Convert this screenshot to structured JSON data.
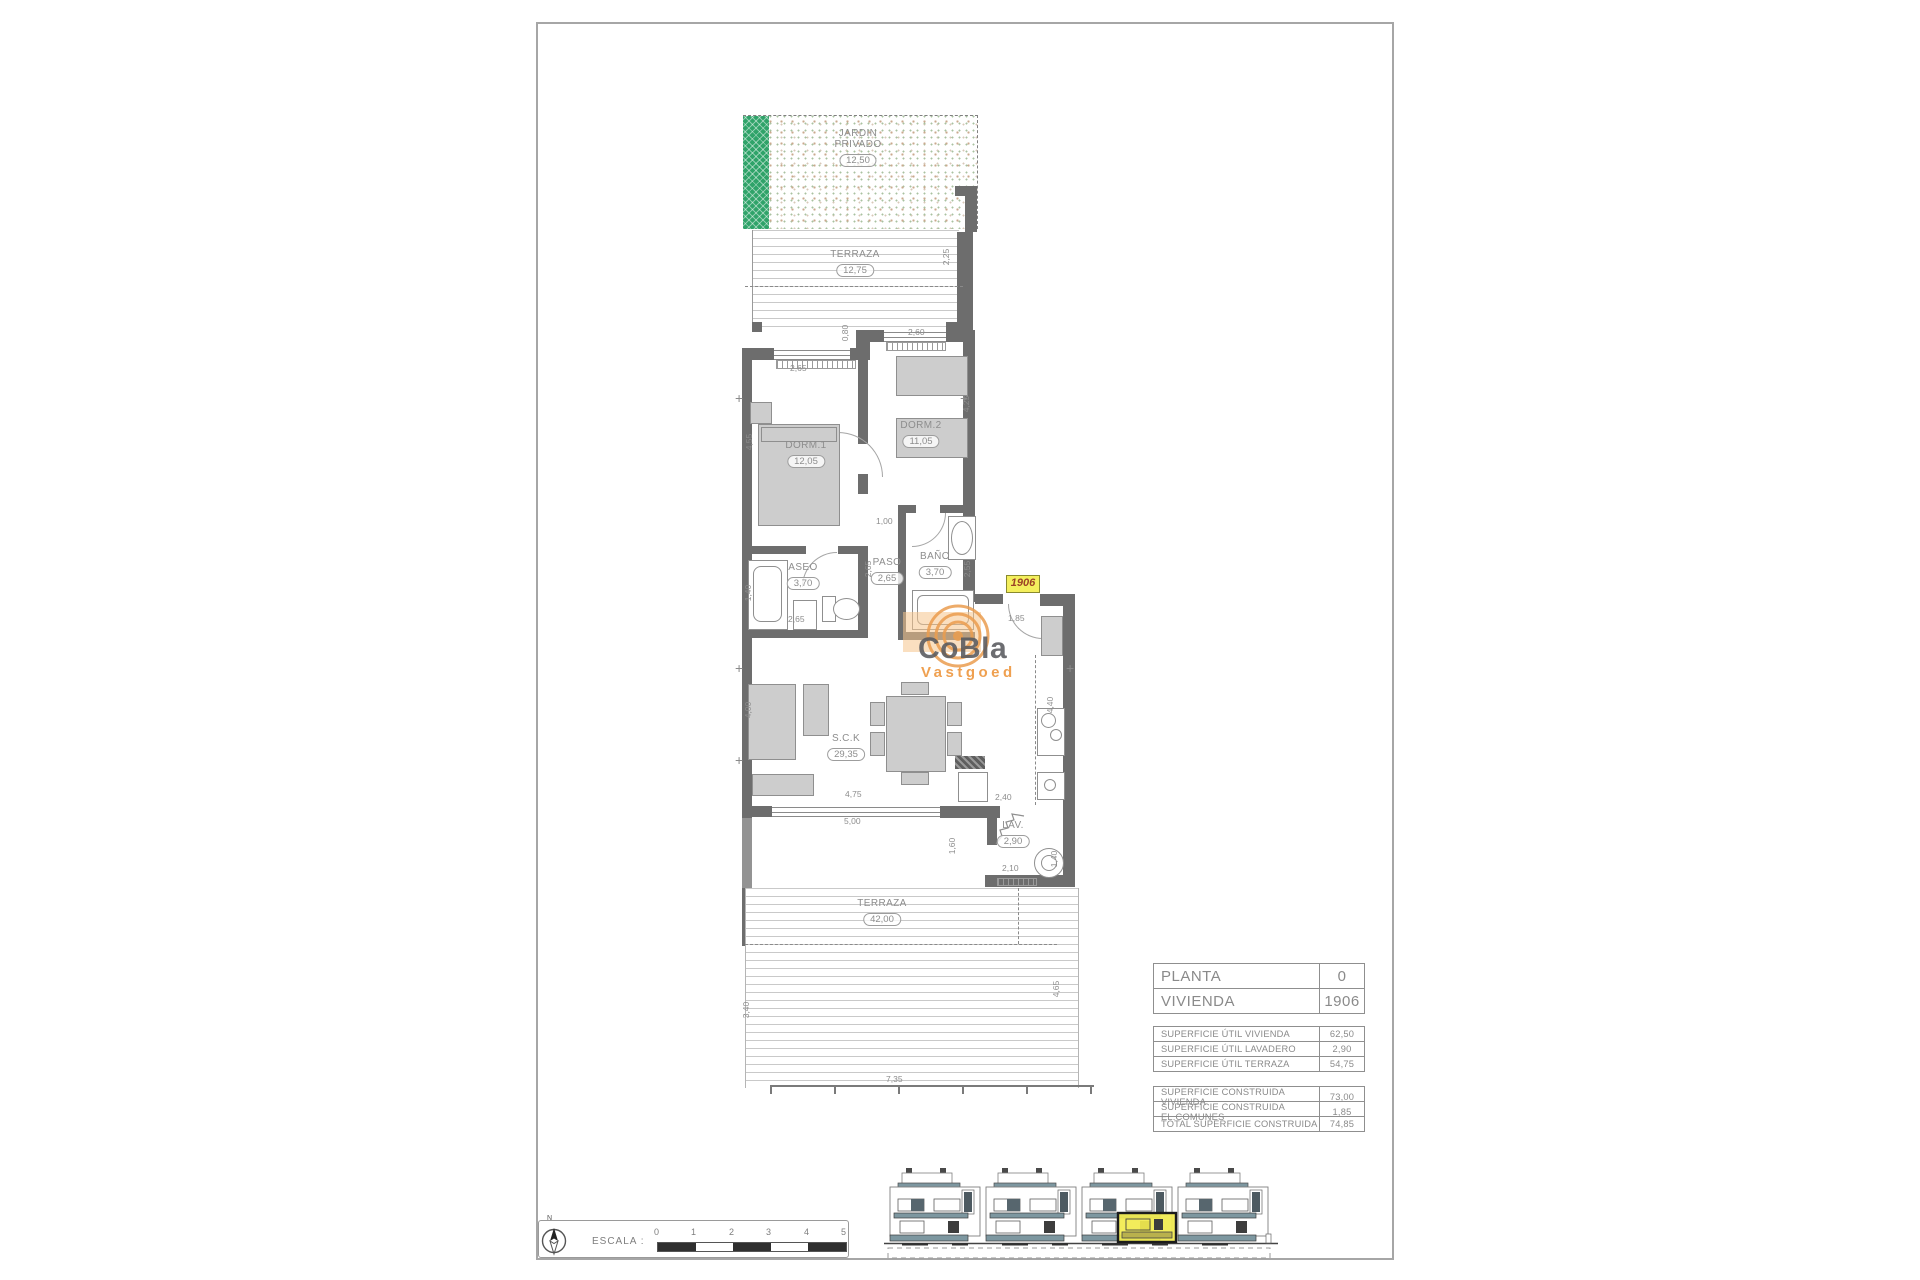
{
  "document": {
    "type_label": "floor plan drawing"
  },
  "unit_label": "1906",
  "logo": {
    "line1": "CoBla",
    "line2": "Vastgoed"
  },
  "rooms": [
    {
      "name": "JARDIN\nPRIVADO",
      "area": "12,50"
    },
    {
      "name": "TERRAZA",
      "area": "12,75"
    },
    {
      "name": "DORM.1",
      "area": "12,05"
    },
    {
      "name": "DORM.2",
      "area": "11,05"
    },
    {
      "name": "ASEO",
      "area": "3,70"
    },
    {
      "name": "PASO",
      "area": "2,65"
    },
    {
      "name": "BAÑO",
      "area": "3,70"
    },
    {
      "name": "S.C.K",
      "area": "29,35"
    },
    {
      "name": "LAV.",
      "area": "2,90"
    },
    {
      "name": "TERRAZA",
      "area": "42,00"
    }
  ],
  "dims": [
    "2,25",
    "0,80",
    "2,60",
    "2,65",
    "4,55",
    "4,25",
    "1,00",
    "2,65",
    "1,40",
    "2,65",
    "2,55",
    "1,85",
    "4,40",
    "4,00",
    "4,75",
    "5,00",
    "2,40",
    "2,10",
    "1,40",
    "1,60",
    "3,40",
    "4,65",
    "7,35"
  ],
  "table": {
    "unit_rows": [
      {
        "label": "PLANTA",
        "value": "0"
      },
      {
        "label": "VIVIENDA",
        "value": "1906"
      }
    ],
    "util_rows": [
      {
        "label": "SUPERFICIE ÚTIL VIVIENDA",
        "value": "62,50"
      },
      {
        "label": "SUPERFICIE ÚTIL LAVADERO",
        "value": "2,90"
      },
      {
        "label": "SUPERFICIE ÚTIL TERRAZA",
        "value": "54,75"
      }
    ],
    "built_rows": [
      {
        "label": "SUPERFICIE CONSTRUIDA VIVIENDA",
        "value": "73,00"
      },
      {
        "label": "SUPERFICIE CONSTRUIDA EL.COMUNES",
        "value": "1,85"
      },
      {
        "label": "TOTAL SUPERFICIE CONSTRUIDA",
        "value": "74,85"
      }
    ]
  },
  "scale": {
    "label": "ESCALA :",
    "ticks": [
      "0",
      "1",
      "2",
      "3",
      "4",
      "5"
    ],
    "north": "N"
  },
  "colors": {
    "wall": "#6d6d6d",
    "garden_green": "#2fa369",
    "highlight_yellow": "#f4ef5d",
    "logo_orange": "#efa050",
    "logo_gray": "#5a5b5e",
    "elevation_teal": "#7d97a0",
    "dim_text": "#8d8d8d"
  }
}
